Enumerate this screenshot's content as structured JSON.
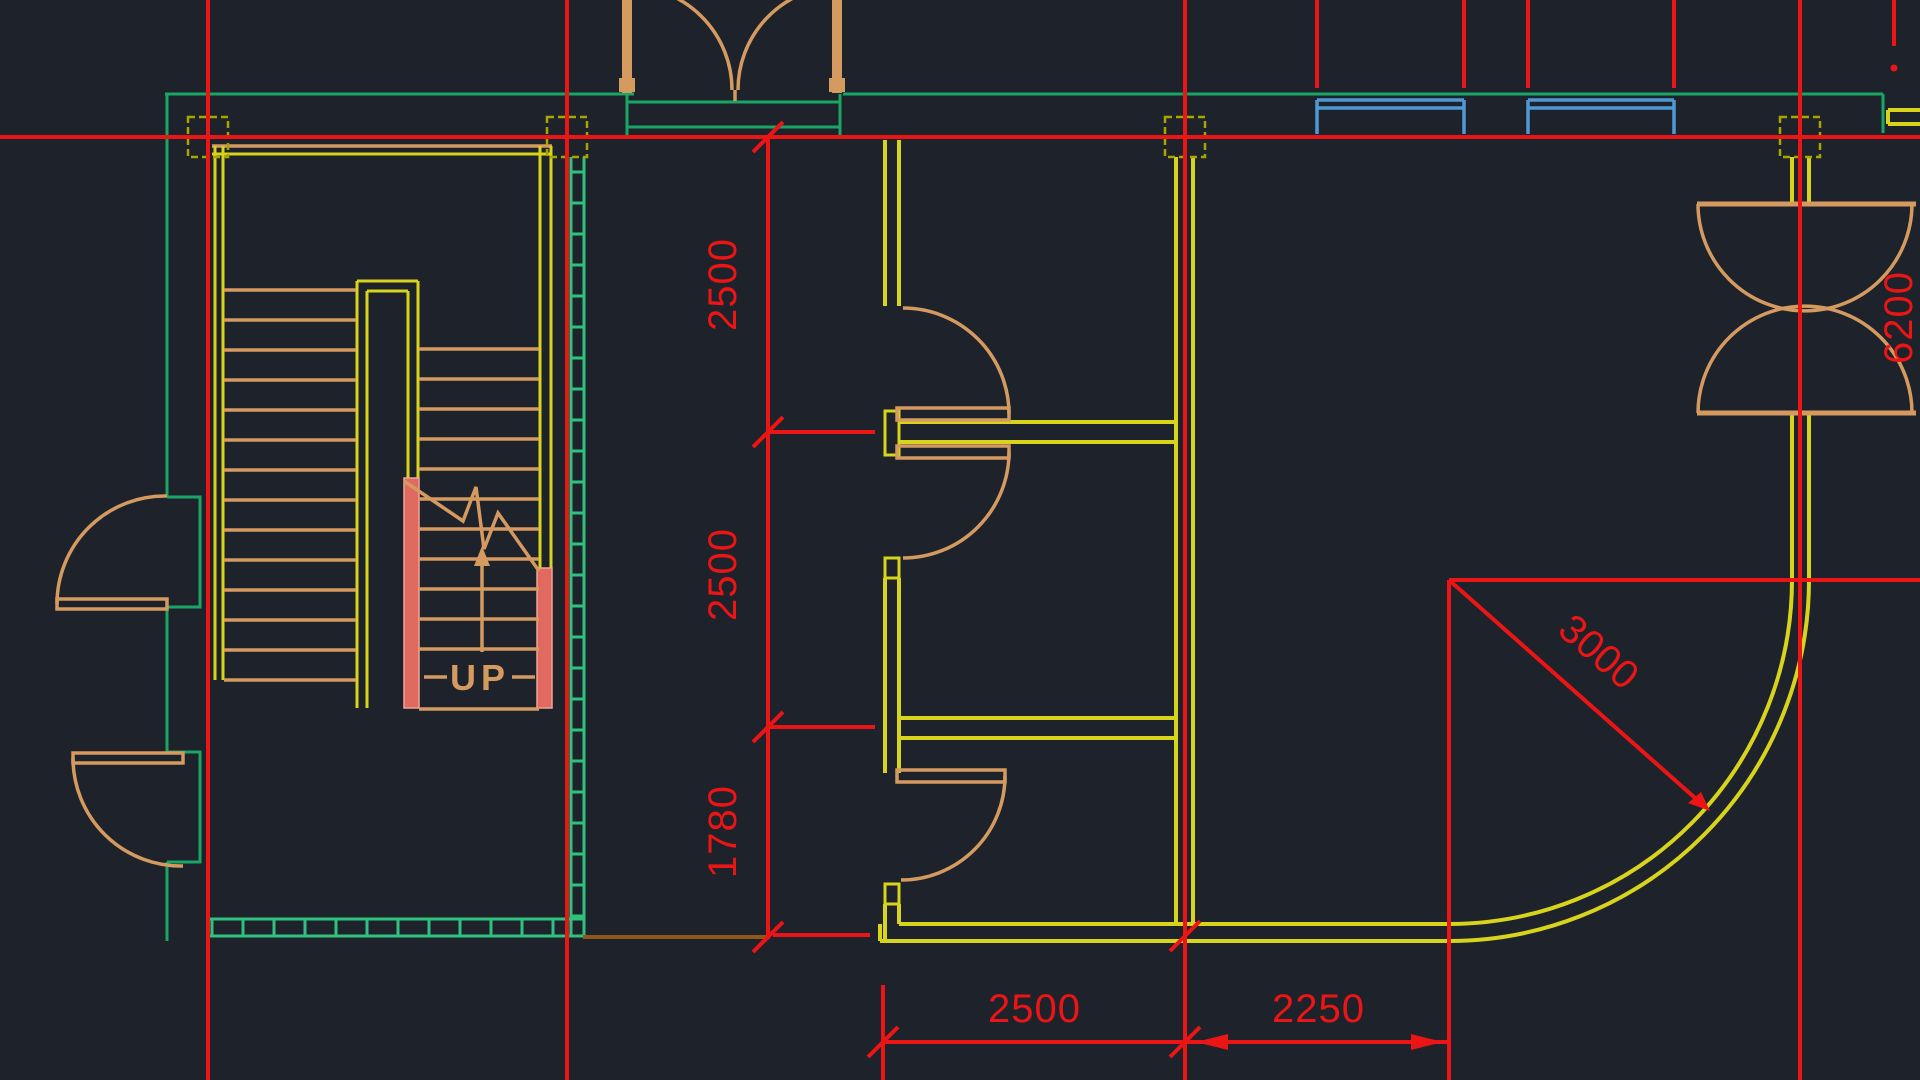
{
  "meta": {
    "title": "CAD floor plan view - stairwell, rooms and curved wall"
  },
  "colors": {
    "bg": "#1e222b",
    "red": "#ec1515",
    "yellow": "#d8d41c",
    "olive": "#a8a400",
    "teal": "#1ba565",
    "mint": "#2fc27e",
    "orange": "#d59a5f",
    "pink": "#e06a60",
    "pinkl": "#f0a396",
    "blue": "#4f9ad6",
    "brown": "#8f5718"
  },
  "dimensions": {
    "vertical_2500_upper": "2500",
    "vertical_2500_lower": "2500",
    "vertical_1780": "1780",
    "bottom_2500": "2500",
    "bottom_2250": "2250",
    "radius_3000": "3000",
    "clipped_right_edge": "6200"
  },
  "labels": {
    "stair_direction": "UP"
  }
}
